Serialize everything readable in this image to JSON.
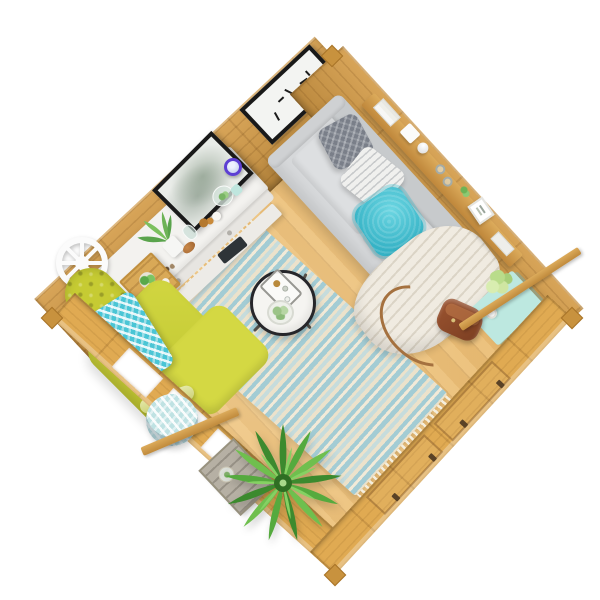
{
  "scene": {
    "description": "Top-down isometric 3D render of a square wooden summerhouse log cabin interior furnished as a lounge, on a plain white background",
    "background": "#ffffff",
    "view": "bird's-eye, room rotated 45 degrees"
  },
  "palette": {
    "wood-wall": "#d49b46",
    "wood-wall-front": "#e0aa52",
    "wood-floor": "#eaba6e",
    "wood-crate": "#d9a957",
    "weathered": "#b6b0a4",
    "sofa-base": "#d6d8da",
    "sofa-back": "#c7cacc",
    "sofa-cushion": "#dddfe1",
    "pillow-grey": "#7a7f89",
    "pillow-white": "#f0f0ee",
    "pillow-teal": "#35b2c5",
    "blanket-cream": "#f0ebe1",
    "chair-yellow": "#c6cb33",
    "chair-yellow-light": "#d2d741",
    "throw-teal": "#4ac5d5",
    "rug-blue": "#a3ccd4",
    "rug-cream": "#ece2cb",
    "rug-blue-light": "#c6dcdc",
    "pouf-teal": "#bfe2e3",
    "coffee-white": "#f5f4f1",
    "coffee-rim": "#26262a",
    "console-white": "#f3f2ef",
    "teal-table": "#bde8e0",
    "bag-brown": "#7c3f22",
    "bag-strap": "#a5713f",
    "leaf-dark": "#3c8a2e",
    "leaf-mid": "#55aa3e",
    "leaf-light": "#6fbf4e",
    "frame-black": "#191919",
    "canvas-white": "#f3f4f2",
    "mirror-purple": "#5d3fd3",
    "wheel-white": "#fbfbfb"
  },
  "objects": {
    "room": {
      "label": "wooden summerhouse interior seen from above"
    },
    "floor": {
      "label": "light pine wood plank floor"
    },
    "walls": {
      "back_left": {
        "label": "back-left log wall with framed art"
      },
      "back_right": {
        "label": "back-right log wall with floating shelf"
      },
      "front_left": {
        "label": "front-left wall with three window openings"
      },
      "front_right": {
        "label": "front-right wall with door panels and hinges"
      }
    },
    "wall_art": {
      "label": "black-framed abstract art print",
      "content": "small black abstract marks on white"
    },
    "wall_shelf": {
      "label": "wooden floating shelf above sofa",
      "items": [
        "stack of white books",
        "white box",
        "white ball ornament",
        "two wine glasses",
        "green sprig",
        "small white picture frame",
        "magazines"
      ]
    },
    "console_table": {
      "label": "white console table with lower shelf",
      "items": [
        "black-framed botanical print",
        "glass terrarium with succulents",
        "potted fern",
        "glass vase",
        "amber bottles",
        "copper bowl",
        "white candle",
        "teal cup",
        "pebbles",
        "dark folder on lower shelf"
      ]
    },
    "mirror": {
      "label": "small round purple-rimmed wall mirror"
    },
    "wheel_clock": {
      "label": "white decorative wheel on wall"
    },
    "sofa": {
      "label": "light grey fabric three-seat sofa against back-right wall",
      "pillows": [
        "dark grey patterned cushion",
        "white wave-patterned cushion",
        "teal fluffy cushion"
      ],
      "blanket": "cream knit throw draped over right end onto floor"
    },
    "rug": {
      "label": "blue and cream striped rug with fringed ends"
    },
    "coffee_table": {
      "label": "round coffee table with black rim on metal legs",
      "items": [
        "serving tray with bottles and glass",
        "bowl of green succulents"
      ]
    },
    "armchair": {
      "label": "chartreuse button-tufted armchair facing the coffee table",
      "throw": "teal and white chevron cushion"
    },
    "crate_table": {
      "label": "small wooden crate side table with potted plant and cup"
    },
    "pouf": {
      "label": "round teal and white chevron pouf"
    },
    "weathered_crate": {
      "label": "weathered grey wooden crate with glass jar of greenery"
    },
    "palm": {
      "label": "large potted green palm plant in front corner"
    },
    "side_table": {
      "label": "mint green side table",
      "items": [
        "vase of pale green hydrangea flowers",
        "white cup"
      ]
    },
    "bag": {
      "label": "brown leather satchel with long strap on floor"
    },
    "planks": {
      "label": "loose wooden trim planks crossing the front walls"
    }
  }
}
